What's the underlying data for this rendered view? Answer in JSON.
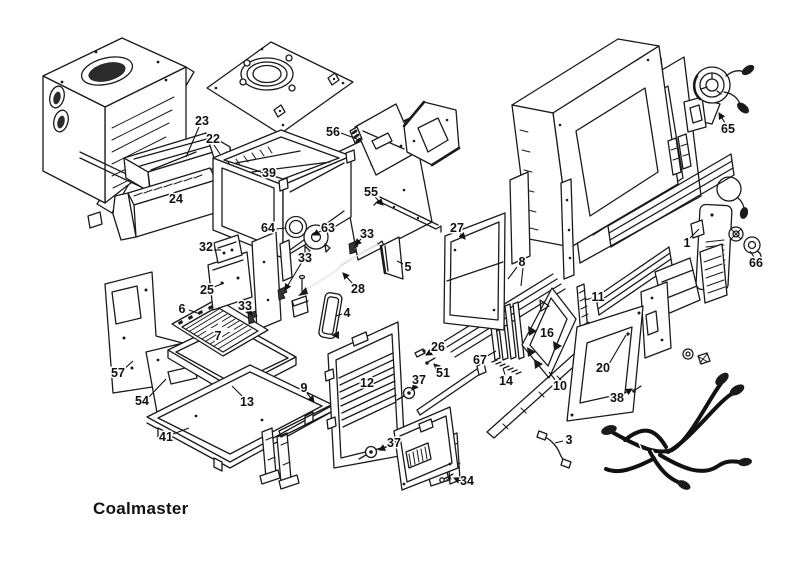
{
  "title": {
    "product_name": "Coalmaster"
  },
  "colors": {
    "ink": "#1a1a1a",
    "paper": "#ffffff"
  },
  "diagram": {
    "type": "exploded-parts-diagram",
    "subject": "Coalmaster coal stove exploded parts view",
    "part_labels": [
      {
        "n": "23"
      },
      {
        "n": "22"
      },
      {
        "n": "24"
      },
      {
        "n": "39"
      },
      {
        "n": "56"
      },
      {
        "n": "55"
      },
      {
        "n": "64"
      },
      {
        "n": "63"
      },
      {
        "n": "33"
      },
      {
        "n": "32"
      },
      {
        "n": "33"
      },
      {
        "n": "25"
      },
      {
        "n": "28"
      },
      {
        "n": "5"
      },
      {
        "n": "4"
      },
      {
        "n": "33"
      },
      {
        "n": "6"
      },
      {
        "n": "7"
      },
      {
        "n": "57"
      },
      {
        "n": "54"
      },
      {
        "n": "41"
      },
      {
        "n": "13"
      },
      {
        "n": "9"
      },
      {
        "n": "12"
      },
      {
        "n": "37"
      },
      {
        "n": "37"
      },
      {
        "n": "26"
      },
      {
        "n": "51"
      },
      {
        "n": "34"
      },
      {
        "n": "27"
      },
      {
        "n": "8"
      },
      {
        "n": "11"
      },
      {
        "n": "16"
      },
      {
        "n": "67"
      },
      {
        "n": "14"
      },
      {
        "n": "10"
      },
      {
        "n": "20"
      },
      {
        "n": "38"
      },
      {
        "n": "3"
      },
      {
        "n": "65"
      },
      {
        "n": "1"
      },
      {
        "n": "66"
      }
    ]
  }
}
